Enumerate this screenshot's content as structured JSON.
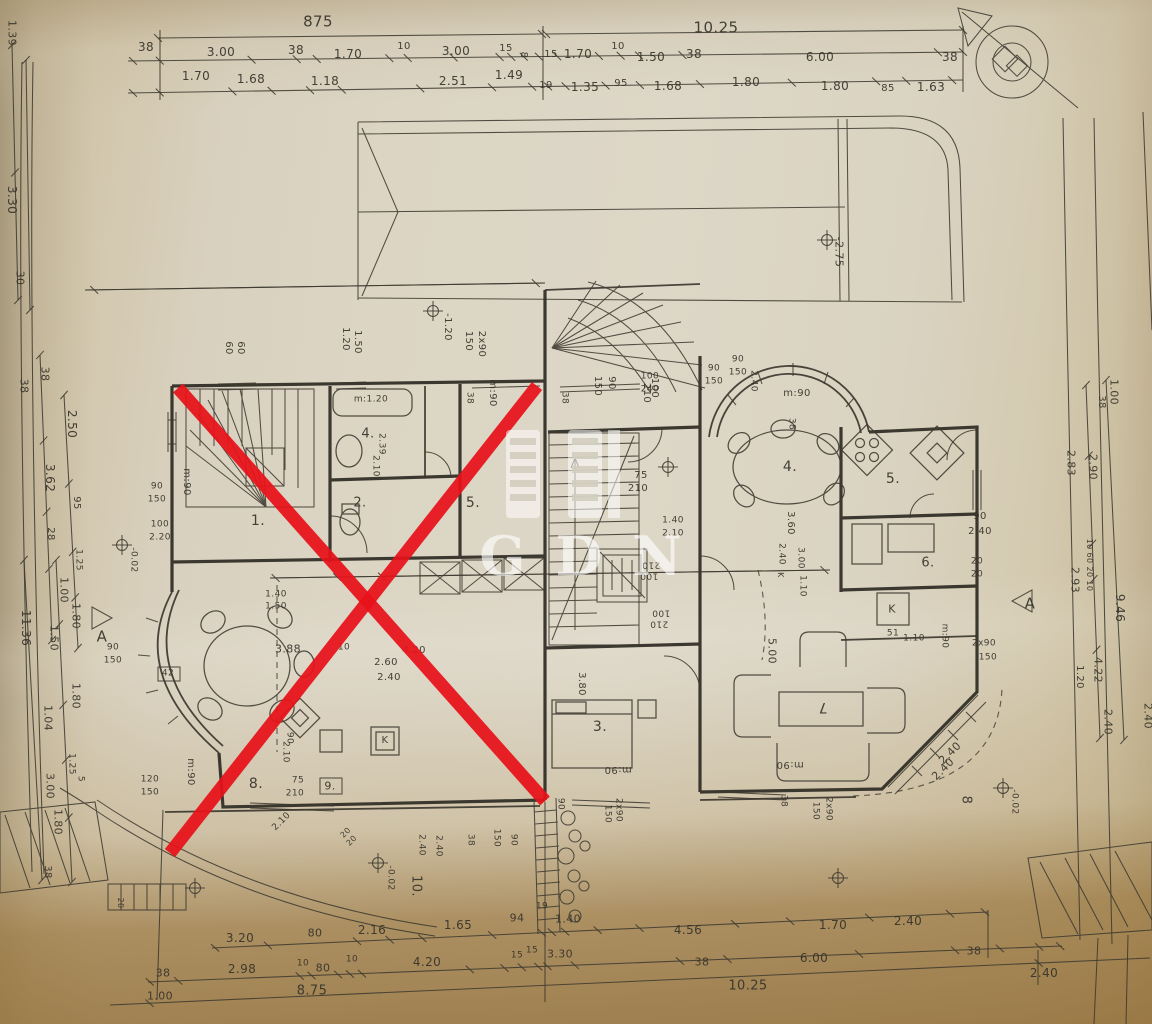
{
  "document": {
    "type": "architectural floor plan photo",
    "watermark_text": "GDN",
    "ink_color": "#3a372e",
    "paper_color": "#dcd5c4",
    "red_cross_color": "#e8121a"
  },
  "red_x": {
    "color": "#e8121a",
    "width": 13,
    "lines": [
      [
        178,
        388,
        545,
        801
      ],
      [
        170,
        853,
        537,
        386
      ]
    ]
  },
  "level_markers": [
    [
      433,
      311
    ],
    [
      827,
      240
    ],
    [
      668,
      467
    ],
    [
      122,
      545
    ],
    [
      1003,
      788
    ],
    [
      378,
      863
    ],
    [
      195,
      888
    ],
    [
      838,
      878
    ]
  ],
  "labels": [
    [
      "875",
      318,
      22,
      0,
      15
    ],
    [
      "10.25",
      716,
      28,
      0,
      15
    ],
    [
      "38",
      146,
      47,
      0,
      12
    ],
    [
      "3.00",
      221,
      52,
      0,
      12
    ],
    [
      "38",
      296,
      50,
      0,
      12
    ],
    [
      "1.70",
      348,
      54,
      0,
      12
    ],
    [
      "10",
      404,
      47,
      0,
      10
    ],
    [
      "3.00",
      456,
      51,
      0,
      12
    ],
    [
      "15",
      506,
      49,
      0,
      10
    ],
    [
      "8",
      523,
      55,
      90,
      10
    ],
    [
      "15",
      551,
      55,
      0,
      10
    ],
    [
      "1.70",
      578,
      54,
      0,
      12
    ],
    [
      "10",
      618,
      47,
      0,
      10
    ],
    [
      "1.50",
      651,
      57,
      0,
      12
    ],
    [
      "38",
      694,
      54,
      0,
      12
    ],
    [
      "6.00",
      820,
      57,
      0,
      12
    ],
    [
      "38",
      950,
      57,
      0,
      12
    ],
    [
      "1.70",
      196,
      76,
      0,
      12
    ],
    [
      "1.68",
      251,
      79,
      0,
      12
    ],
    [
      "1.18",
      325,
      81,
      0,
      12
    ],
    [
      "2.51",
      453,
      81,
      0,
      12
    ],
    [
      "1.49",
      509,
      75,
      0,
      12
    ],
    [
      "19",
      546,
      86,
      0,
      10
    ],
    [
      "1.35",
      585,
      87,
      0,
      12
    ],
    [
      "95",
      621,
      84,
      0,
      10
    ],
    [
      "1.68",
      668,
      86,
      0,
      12
    ],
    [
      "1.80",
      746,
      82,
      0,
      12
    ],
    [
      "1.80",
      835,
      86,
      0,
      12
    ],
    [
      "85",
      888,
      89,
      0,
      10
    ],
    [
      "1.63",
      931,
      87,
      0,
      12
    ],
    [
      "1.39",
      12,
      33,
      90,
      11
    ],
    [
      "3.30",
      12,
      200,
      90,
      12
    ],
    [
      "30",
      20,
      278,
      90,
      11
    ],
    [
      "38",
      45,
      374,
      90,
      11
    ],
    [
      "38",
      24,
      386,
      90,
      11
    ],
    [
      "2.50",
      72,
      424,
      90,
      12
    ],
    [
      "3.62",
      50,
      478,
      90,
      12
    ],
    [
      "95",
      76,
      503,
      90,
      10
    ],
    [
      "28",
      50,
      534,
      90,
      10
    ],
    [
      "1.25",
      78,
      560,
      90,
      9
    ],
    [
      "1.00",
      64,
      590,
      90,
      11
    ],
    [
      "11.36",
      26,
      628,
      90,
      12
    ],
    [
      "1.80",
      76,
      616,
      90,
      11
    ],
    [
      "1.50",
      54,
      638,
      90,
      11
    ],
    [
      "1.80",
      76,
      696,
      90,
      11
    ],
    [
      "1.04",
      48,
      718,
      90,
      11
    ],
    [
      "1.25",
      71,
      764,
      90,
      9
    ],
    [
      "5",
      80,
      779,
      90,
      9
    ],
    [
      "3.00",
      50,
      786,
      90,
      11
    ],
    [
      "1.80",
      58,
      822,
      90,
      11
    ],
    [
      "38",
      47,
      872,
      90,
      10
    ],
    [
      "A",
      102,
      637,
      0,
      15
    ],
    [
      "A",
      1030,
      604,
      0,
      15
    ],
    [
      "1.00",
      1114,
      392,
      90,
      11
    ],
    [
      "38",
      1101,
      402,
      90,
      10
    ],
    [
      "2.83",
      1071,
      463,
      90,
      11
    ],
    [
      "2.90",
      1093,
      467,
      90,
      11
    ],
    [
      "10 60 20 10",
      1089,
      565,
      90,
      8
    ],
    [
      "2.93",
      1075,
      580,
      90,
      11
    ],
    [
      "9.46",
      1120,
      608,
      90,
      12
    ],
    [
      "4.22",
      1098,
      670,
      90,
      11
    ],
    [
      "1.20",
      1079,
      677,
      90,
      10
    ],
    [
      "2.40",
      1108,
      722,
      90,
      11
    ],
    [
      "2.40",
      1148,
      716,
      90,
      11
    ],
    [
      "60",
      228,
      348,
      90,
      10
    ],
    [
      "60",
      240,
      348,
      90,
      10
    ],
    [
      "1.20",
      345,
      339,
      90,
      10
    ],
    [
      "1.50",
      357,
      342,
      90,
      10
    ],
    [
      "150",
      468,
      341,
      90,
      10
    ],
    [
      "2x90",
      481,
      344,
      90,
      10
    ],
    [
      "-1.20",
      447,
      327,
      90,
      10
    ],
    [
      "m:90",
      492,
      393,
      90,
      10
    ],
    [
      "38",
      469,
      398,
      90,
      9
    ],
    [
      "38",
      564,
      398,
      90,
      9
    ],
    [
      "150",
      597,
      386,
      90,
      10
    ],
    [
      "90",
      611,
      383,
      90,
      10
    ],
    [
      "100",
      654,
      388,
      90,
      10
    ],
    [
      "210",
      646,
      393,
      90,
      10
    ],
    [
      "-2.75",
      839,
      252,
      90,
      11
    ],
    [
      "100",
      650,
      377,
      0,
      9
    ],
    [
      "240",
      650,
      390,
      0,
      9
    ],
    [
      "90",
      714,
      369,
      0,
      9
    ],
    [
      "150",
      714,
      382,
      0,
      9
    ],
    [
      "90",
      738,
      360,
      0,
      9
    ],
    [
      "150",
      738,
      373,
      0,
      9
    ],
    [
      "2.40",
      753,
      381,
      90,
      9
    ],
    [
      "m:90",
      186,
      482,
      90,
      10
    ],
    [
      "1.",
      258,
      521,
      0,
      14
    ],
    [
      "2.",
      360,
      503,
      0,
      13
    ],
    [
      "4.",
      368,
      434,
      0,
      13
    ],
    [
      "m:1.20",
      371,
      400,
      0,
      9
    ],
    [
      "2.39",
      381,
      444,
      90,
      9
    ],
    [
      "2.10",
      375,
      466,
      90,
      9
    ],
    [
      "5.",
      473,
      503,
      0,
      14
    ],
    [
      "90",
      157,
      487,
      0,
      9
    ],
    [
      "150",
      157,
      500,
      0,
      9
    ],
    [
      "100",
      160,
      525,
      0,
      9
    ],
    [
      "2.20",
      160,
      538,
      0,
      9
    ],
    [
      "90",
      113,
      648,
      0,
      9
    ],
    [
      "150",
      113,
      661,
      0,
      9
    ],
    [
      "42",
      168,
      674,
      0,
      9
    ],
    [
      "120",
      150,
      780,
      0,
      9
    ],
    [
      "150",
      150,
      793,
      0,
      9
    ],
    [
      "m:90",
      190,
      772,
      90,
      10
    ],
    [
      "1.40",
      276,
      595,
      0,
      9
    ],
    [
      "1.50",
      276,
      607,
      0,
      9
    ],
    [
      "3.88",
      288,
      649,
      0,
      11
    ],
    [
      "10",
      344,
      648,
      0,
      9
    ],
    [
      "2.60",
      386,
      663,
      0,
      10
    ],
    [
      "2.40",
      389,
      678,
      0,
      10
    ],
    [
      "4.20",
      414,
      651,
      0,
      10
    ],
    [
      "90",
      289,
      738,
      90,
      9
    ],
    [
      "2.10",
      285,
      752,
      90,
      9
    ],
    [
      "8.",
      256,
      784,
      0,
      14
    ],
    [
      "9.",
      330,
      786,
      0,
      11
    ],
    [
      "75",
      298,
      781,
      0,
      9
    ],
    [
      "210",
      295,
      794,
      0,
      9
    ],
    [
      "K",
      385,
      741,
      0,
      10
    ],
    [
      "2.10",
      282,
      822,
      -45,
      9
    ],
    [
      "20",
      346,
      833,
      -45,
      8
    ],
    [
      "20",
      352,
      841,
      -45,
      8
    ],
    [
      "75",
      641,
      476,
      0,
      10
    ],
    [
      "210",
      638,
      489,
      0,
      10
    ],
    [
      "1.40",
      673,
      521,
      0,
      9
    ],
    [
      "2.10",
      673,
      534,
      0,
      9
    ],
    [
      "100",
      649,
      575,
      180,
      9
    ],
    [
      "210",
      651,
      564,
      180,
      9
    ],
    [
      "100",
      661,
      612,
      180,
      9
    ],
    [
      "210",
      659,
      623,
      180,
      9
    ],
    [
      "3.80",
      581,
      684,
      90,
      10
    ],
    [
      "3.",
      600,
      727,
      0,
      14
    ],
    [
      "m:90",
      618,
      769,
      180,
      10
    ],
    [
      "90",
      560,
      804,
      90,
      9
    ],
    [
      "2x90",
      618,
      810,
      90,
      9
    ],
    [
      "150",
      607,
      814,
      90,
      9
    ],
    [
      "m:90",
      797,
      394,
      0,
      10
    ],
    [
      "38",
      791,
      424,
      90,
      9
    ],
    [
      "4.",
      790,
      467,
      0,
      14
    ],
    [
      "5.",
      893,
      479,
      0,
      14
    ],
    [
      "3.60",
      790,
      523,
      90,
      10
    ],
    [
      "2.40",
      781,
      554,
      90,
      9
    ],
    [
      "K",
      780,
      575,
      90,
      8
    ],
    [
      "3.00",
      800,
      558,
      90,
      9
    ],
    [
      "1.10",
      802,
      586,
      90,
      9
    ],
    [
      "90",
      980,
      517,
      0,
      10
    ],
    [
      "2.40",
      980,
      532,
      0,
      10
    ],
    [
      "20",
      977,
      562,
      0,
      9
    ],
    [
      "20",
      977,
      575,
      0,
      9
    ],
    [
      "6.",
      928,
      563,
      0,
      13
    ],
    [
      "K",
      892,
      609,
      0,
      11
    ],
    [
      "51",
      893,
      634,
      0,
      9
    ],
    [
      "1.10",
      914,
      639,
      0,
      9
    ],
    [
      "m:90",
      944,
      636,
      90,
      9
    ],
    [
      "2x90",
      984,
      644,
      0,
      9
    ],
    [
      "150",
      988,
      658,
      0,
      9
    ],
    [
      "5.00",
      772,
      651,
      90,
      11
    ],
    [
      "7",
      823,
      707,
      180,
      14
    ],
    [
      "m:90",
      790,
      764,
      180,
      10
    ],
    [
      "38",
      783,
      801,
      90,
      9
    ],
    [
      "150",
      815,
      811,
      90,
      9
    ],
    [
      "2x90",
      828,
      809,
      90,
      9
    ],
    [
      "2.40",
      950,
      753,
      -45,
      11
    ],
    [
      "2.40",
      943,
      769,
      -45,
      11
    ],
    [
      "8",
      966,
      800,
      90,
      13
    ],
    [
      "-0.02",
      133,
      560,
      90,
      9
    ],
    [
      "-0.02",
      1014,
      802,
      90,
      9
    ],
    [
      "-0.02",
      390,
      878,
      90,
      9
    ],
    [
      "10.",
      416,
      886,
      90,
      13
    ],
    [
      "2.40",
      421,
      845,
      90,
      9
    ],
    [
      "2.40",
      438,
      846,
      90,
      9
    ],
    [
      "38",
      470,
      840,
      90,
      9
    ],
    [
      "150",
      496,
      838,
      90,
      9
    ],
    [
      "90",
      513,
      840,
      90,
      9
    ],
    [
      "20",
      120,
      903,
      90,
      8
    ],
    [
      "3.20",
      240,
      938,
      0,
      12
    ],
    [
      "80",
      315,
      933,
      0,
      11
    ],
    [
      "2.16",
      372,
      930,
      0,
      12
    ],
    [
      "1.65",
      458,
      925,
      0,
      12
    ],
    [
      "94",
      517,
      918,
      0,
      11
    ],
    [
      "19",
      542,
      907,
      0,
      9
    ],
    [
      "1.40",
      568,
      919,
      0,
      11
    ],
    [
      "4.56",
      688,
      930,
      0,
      12
    ],
    [
      "1.70",
      833,
      925,
      0,
      12
    ],
    [
      "2.40",
      908,
      921,
      0,
      12
    ],
    [
      "38",
      163,
      973,
      0,
      11
    ],
    [
      "2.98",
      242,
      969,
      0,
      12
    ],
    [
      "10",
      303,
      964,
      0,
      9
    ],
    [
      "80",
      323,
      968,
      0,
      11
    ],
    [
      "10",
      352,
      960,
      0,
      9
    ],
    [
      "4.20",
      427,
      962,
      0,
      12
    ],
    [
      "15",
      517,
      956,
      0,
      9
    ],
    [
      "15",
      532,
      951,
      0,
      9
    ],
    [
      "3.30",
      560,
      954,
      0,
      11
    ],
    [
      "38",
      702,
      962,
      0,
      11
    ],
    [
      "6.00",
      814,
      958,
      0,
      12
    ],
    [
      "38",
      974,
      951,
      0,
      11
    ],
    [
      "1.00",
      160,
      996,
      0,
      11
    ],
    [
      "8.75",
      312,
      991,
      0,
      13
    ],
    [
      "10.25",
      748,
      986,
      0,
      13
    ],
    [
      "2.40",
      1044,
      973,
      0,
      12
    ]
  ]
}
